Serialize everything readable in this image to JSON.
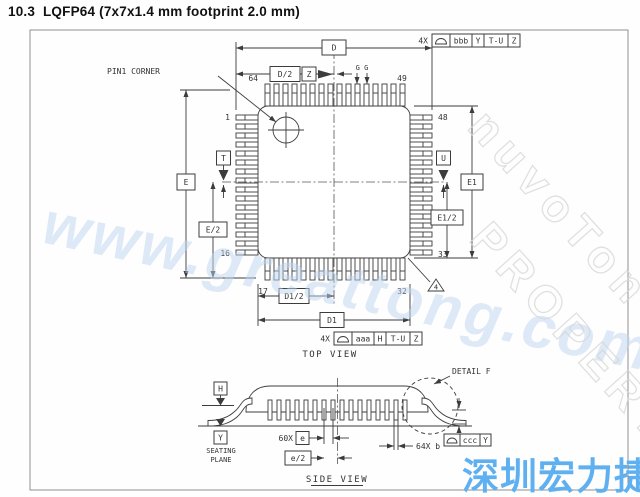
{
  "title": "10.3  LQFP64 (7x7x1.4 mm footprint 2.0 mm)",
  "top_view": {
    "label": "TOP VIEW",
    "pin1_corner": "PIN1 CORNER",
    "pins": {
      "n1": "1",
      "n16": "16",
      "n17": "17",
      "n32": "32",
      "n33": "33",
      "n48": "48",
      "n49": "49",
      "n64": "64"
    },
    "dims": {
      "D": "D",
      "D2": "D/2",
      "D1": "D1",
      "D12": "D1/2",
      "E": "E",
      "E2": "E/2",
      "E1": "E1",
      "E12": "E1/2",
      "G": "G G"
    },
    "datums": {
      "T": "T",
      "U": "U",
      "Z": "Z"
    },
    "note_flag": "4",
    "fcf_top": {
      "qty": "4X",
      "tol": "bbb",
      "d1": "Y",
      "d2": "T-U",
      "d3": "Z"
    },
    "fcf_bottom": {
      "qty": "4X",
      "tol": "aaa",
      "d1": "H",
      "d2": "T-U",
      "d3": "Z"
    }
  },
  "side_view": {
    "label": "SIDE VIEW",
    "detail": "DETAIL F",
    "seating1": "SEATING",
    "seating2": "PLANE",
    "datums": {
      "H": "H",
      "Y": "Y"
    },
    "dims": {
      "pitch_qty": "60X",
      "pitch": "e",
      "half_pitch": "e/2",
      "lead_width": "64X b"
    },
    "fcf": {
      "tol": "ccc",
      "d1": "Y"
    }
  },
  "watermarks": {
    "url": "www.greattong.com",
    "brand": "nuvoTon",
    "brand2": "PROPERTY",
    "cjk": "深圳宏力捷"
  },
  "icons": {
    "fcf_profile_symbol": "⌓"
  },
  "colors": {
    "line": "#3c3c3c",
    "cjk_blue": "#5fb0f0",
    "url_blue": "#bdd5ef",
    "property_gray": "#d6d6d6"
  }
}
